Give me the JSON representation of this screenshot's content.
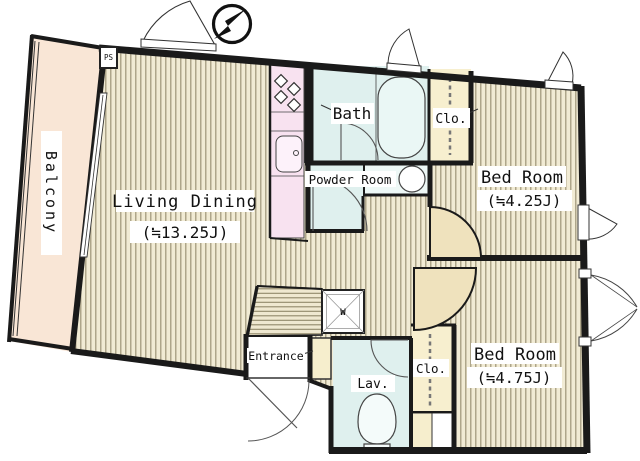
{
  "plan": {
    "type": "apartment-floor-plan",
    "compass": "north-arrow-pointing-northeast",
    "labels": {
      "ps": "PS",
      "balcony": "Balcony",
      "living_dining": "Living Dining",
      "living_dining_size": "(≒13.25J)",
      "bath": "Bath",
      "powder_room": "Powder Room",
      "closet_upper": "Clo.",
      "closet_lower": "Clo.",
      "bed_room_upper": "Bed Room",
      "bed_room_upper_size": "(≒4.25J)",
      "bed_room_lower": "Bed Room",
      "bed_room_lower_size": "(≒4.75J)",
      "entrance": "Entrance",
      "lavatory": "Lav.",
      "washer": "W"
    },
    "colors": {
      "wall": "#1a1a1a",
      "floor_stripe_bg": "#f1ebd4",
      "floor_stripe_line": "#9d9478",
      "balcony": "#f9e6d6",
      "kitchen": "#f8e2f0",
      "wet_room": "#dff0ee",
      "closet": "#f7efcf",
      "door_leaf": "#efe2bd",
      "fixture": "#ffffff",
      "background": "#ffffff"
    }
  }
}
